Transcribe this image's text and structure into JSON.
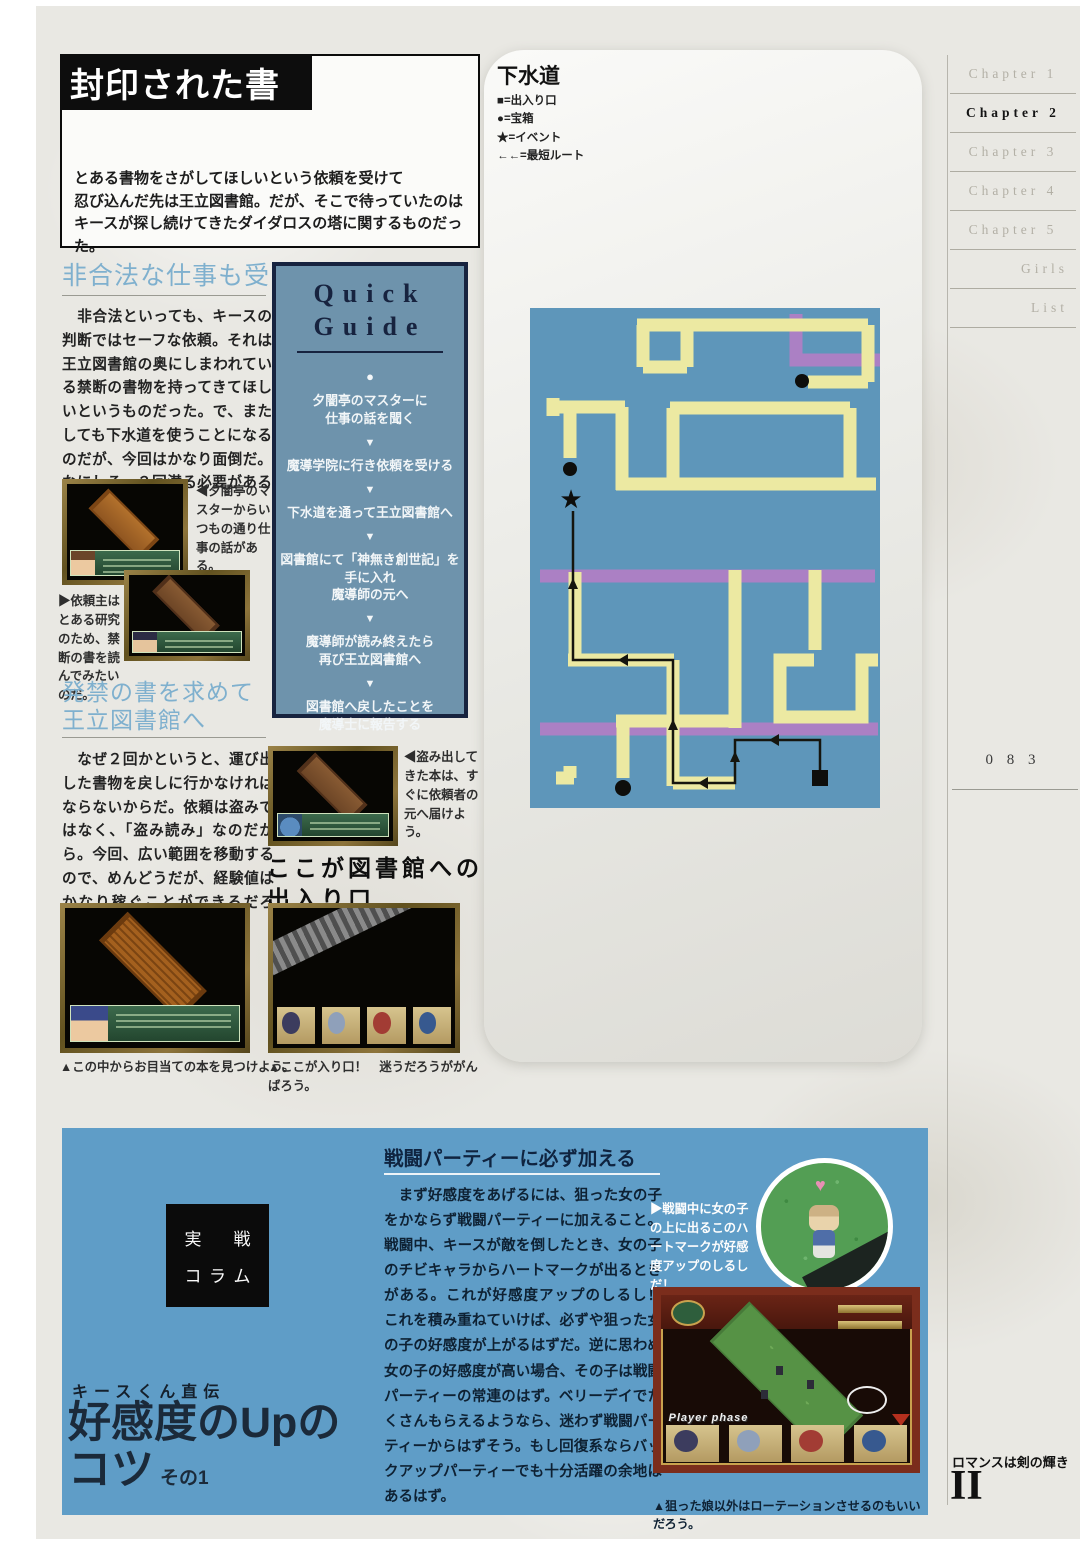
{
  "header": {
    "title": "封印された書",
    "intro_lines": [
      "とある書物をさがしてほしいという依頼を受けて",
      "忍び込んだ先は王立図書館。だが、そこで待っていたのは",
      "キースが探し続けてきたダイダロスの塔に関するものだった。"
    ]
  },
  "left_column": {
    "section1": {
      "heading": "非合法な仕事も受ける",
      "body": "　非合法といっても、キースの判断ではセーフな依頼。それは王立図書館の奥にしまわれている禁断の書物を持ってきてほしいというものだった。で、またしても下水道を使うことになるのだが、今回はかなり面倒だ。なにしろ、２回潜る必要があるのだ！"
    },
    "caption_master": "◀夕闇亭のマスターからいつもの通り仕事の話がある。",
    "caption_client": "▶依頼主はとある研究のため、禁断の書を読んでみたいのだ。",
    "section2": {
      "heading_line1": "発禁の書を求めて",
      "heading_line2": "王立図書館へ",
      "body": "　なぜ２回かというと、運び出した書物を戻しに行かなければならないからだ。依頼は盗みではなく、「盗み読み」なのだから。今回、広い範囲を移動するので、めんどうだが、経験値はかなり稼ぐことができるだろう。"
    },
    "caption_library": "▲この中からお目当ての本を見つけよう。"
  },
  "quick_guide": {
    "title_line1": "Quick",
    "title_line2": "Guide",
    "bullet": "●",
    "arrow": "▼",
    "steps": [
      "夕闇亭のマスターに\n仕事の話を聞く",
      "魔導学院に行き依頼を受ける",
      "下水道を通って王立図書館へ",
      "図書館にて「神無き創世記」を\n手に入れ\n魔導師の元へ",
      "魔導師が読み終えたら\n再び王立図書館へ",
      "図書館へ戻したことを\n魔導士に報告する"
    ]
  },
  "mid_column": {
    "caption_book": "◀盗み出してきた本は、すぐに依頼者の元へ届けよう。",
    "headline_line1": "ここが図書館への",
    "headline_line2": "出入り口",
    "caption_entrance": "▲ここが入り口！　迷うだろうががんばろう。"
  },
  "map": {
    "title": "下水道",
    "legend": [
      "■=出入り口",
      "●=宝箱",
      "★=イベント",
      "←←=最短ルート"
    ]
  },
  "sidebar": {
    "items": [
      {
        "label": "Chapter 1"
      },
      {
        "label": "Chapter 2"
      },
      {
        "label": "Chapter 3"
      },
      {
        "label": "Chapter 4"
      },
      {
        "label": "Chapter 5"
      },
      {
        "label": "Girls"
      },
      {
        "label": "List"
      }
    ],
    "page_number": "0 8 3"
  },
  "column_panel": {
    "badge_chars": [
      "実",
      "戦",
      "コ",
      "ラ",
      "ム"
    ],
    "kicker": "キースくん直伝",
    "title_main": "好感度のUpの",
    "title_sub": "コツ",
    "title_note": "その1",
    "header": "戦闘パーティーに必ず加える",
    "body": "　まず好感度をあげるには、狙った女の子をかならず戦闘パーティーに加えること。戦闘中、キースが敵を倒したとき、女の子のチビキャラからハートマークが出るときがある。これが好感度アップのしるし！　これを積み重ねていけば、必ずや狙った女の子の好感度が上がるはずだ。逆に思わぬ女の子の好感度が高い場合、その子は戦闘パーティーの常連のはず。ベリーデイでたくさんもらえるようなら、迷わず戦闘パーティーからはずそう。もし回復系ならバックアップパーティーでも十分活躍の余地はあるはず。",
    "caption_heart": "▶戦闘中に女の子の上に出るこのハートマークが好感度アップのしるしだ！",
    "heart_icon": "♥",
    "screenshot_label": "Player phase",
    "caption_rotation": "▲狙った娘以外はローテーションさせるのもいいだろう。"
  },
  "footer": {
    "book_title": "ロマンスは剣の輝き",
    "volume": "II"
  },
  "colors": {
    "map_blue": "#5e96ba",
    "path_yellow": "#ece9a2",
    "water_purple": "#ab80c4",
    "panel_blue": "#5f9dc7",
    "heading_blue": "#7fb0ce"
  }
}
